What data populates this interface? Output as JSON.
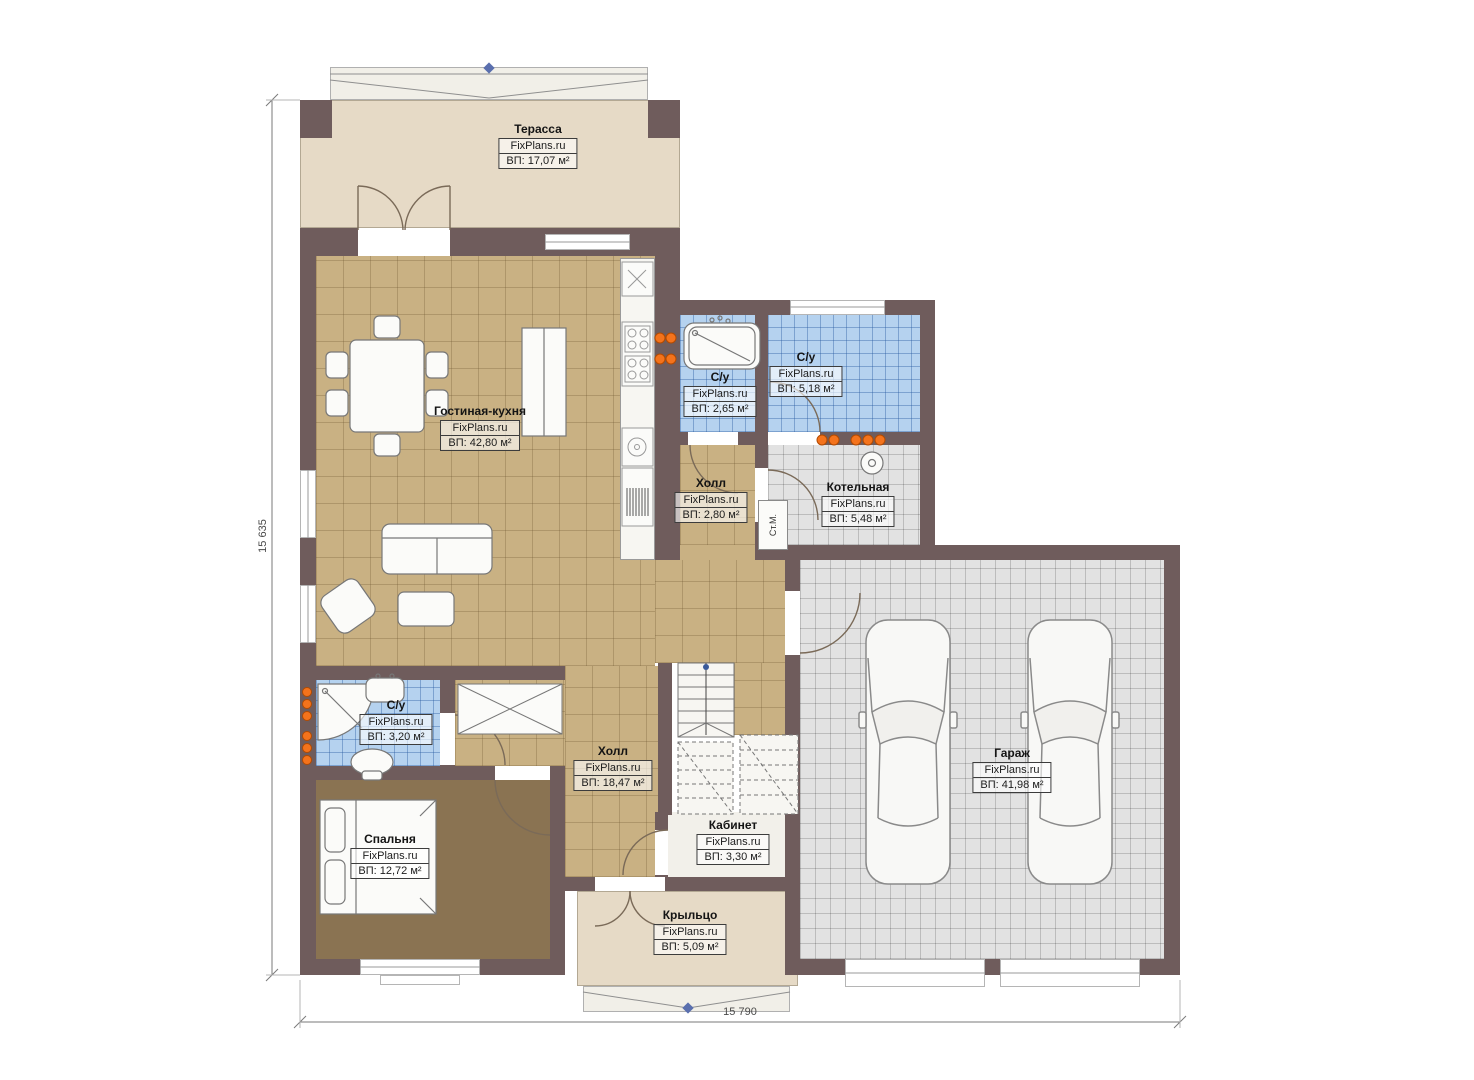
{
  "plan": {
    "brand": "FixPlans.ru",
    "rooms": [
      {
        "key": "terrace",
        "name": "Терасса",
        "area": "ВП: 17,07 м²"
      },
      {
        "key": "living",
        "name": "Гостиная-кухня",
        "area": "ВП: 42,80 м²"
      },
      {
        "key": "wc_top_left",
        "name": "С/у",
        "area": "ВП: 2,65 м²"
      },
      {
        "key": "wc_top_right",
        "name": "С/у",
        "area": "ВП: 5,18 м²"
      },
      {
        "key": "hall_upper",
        "name": "Холл",
        "area": "ВП: 2,80 м²"
      },
      {
        "key": "boiler",
        "name": "Котельная",
        "area": "ВП: 5,48 м²"
      },
      {
        "key": "wc_bottom",
        "name": "С/у",
        "area": "ВП: 3,20 м²"
      },
      {
        "key": "hall_main",
        "name": "Холл",
        "area": "ВП: 18,47 м²"
      },
      {
        "key": "bedroom",
        "name": "Спальня",
        "area": "ВП: 12,72 м²"
      },
      {
        "key": "cabinet",
        "name": "Кабинет",
        "area": "ВП: 3,30 м²"
      },
      {
        "key": "porch",
        "name": "Крыльцо",
        "area": "ВП: 5,09 м²"
      },
      {
        "key": "garage",
        "name": "Гараж",
        "area": "ВП: 41,98 м²"
      }
    ],
    "annotations": {
      "washing_machine": "Ст.М."
    },
    "dimensions": {
      "left_total": "15 635",
      "bottom_total": "15 790"
    },
    "colors": {
      "wall": "#6f5c5c",
      "floor_tan": "#c9b183",
      "floor_blue": "#b5d2ef",
      "floor_gray": "#e2e2e2",
      "floor_beige": "#e6dac6",
      "floor_bedroom": "#8a7352",
      "radiator": "#f4731c",
      "marker_blue": "#5a6fae"
    }
  }
}
